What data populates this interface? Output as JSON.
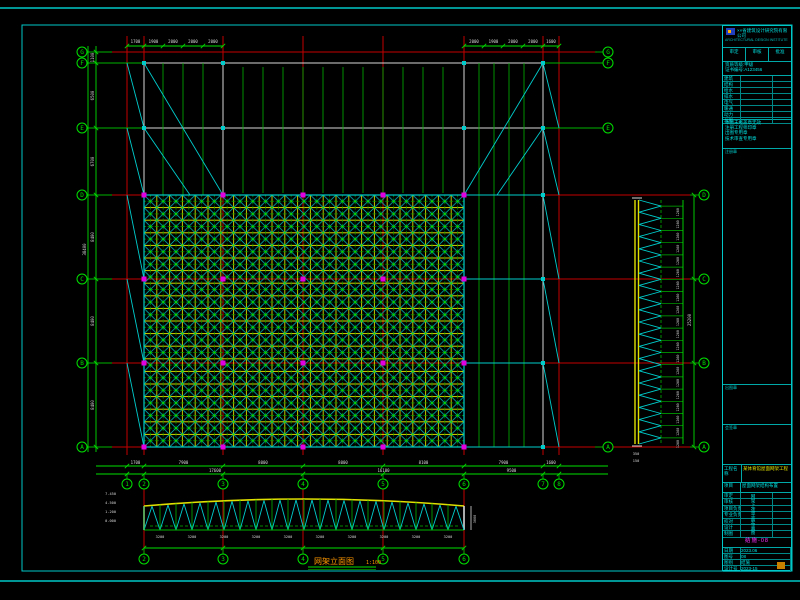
{
  "colors": {
    "background": "#000000",
    "sheet_border": "#00c8c8",
    "grid_red": "#c40000",
    "green": "#00b400",
    "bright_green": "#00e000",
    "yellow": "#e0e000",
    "cyan": "#00cccc",
    "white": "#d8d8d8",
    "magenta": "#e000e0",
    "orange": "#ff9900",
    "title_text": "#00e0e0"
  },
  "plan": {
    "col_grids": [
      {
        "label": "1",
        "x": 127
      },
      {
        "label": "2",
        "x": 144
      },
      {
        "label": "3",
        "x": 223
      },
      {
        "label": "4",
        "x": 303
      },
      {
        "label": "5",
        "x": 383
      },
      {
        "label": "6",
        "x": 464
      },
      {
        "label": "7",
        "x": 543
      },
      {
        "label": "8",
        "x": 559
      }
    ],
    "row_grids": [
      {
        "label": "G",
        "y": 52
      },
      {
        "label": "F",
        "y": 63
      },
      {
        "label": "E",
        "y": 128
      },
      {
        "label": "D",
        "y": 195
      },
      {
        "label": "C",
        "y": 279
      },
      {
        "label": "B",
        "y": 363
      },
      {
        "label": "A",
        "y": 447
      }
    ],
    "right_row_bubbles": [
      "G",
      "F",
      "E",
      "A"
    ],
    "top_dims_left": {
      "ticks": [
        127,
        144,
        163,
        183,
        203,
        223
      ],
      "values": [
        "1700",
        "1900",
        "2000",
        "2000",
        "2000"
      ]
    },
    "top_dims_right": {
      "ticks": [
        464,
        484,
        503,
        523,
        543,
        559
      ],
      "values": [
        "2000",
        "1900",
        "2000",
        "2000",
        "1600"
      ]
    },
    "left_dims": {
      "values": [
        "1100",
        "6500",
        "6700",
        "8400",
        "8400",
        "8400"
      ],
      "total": "38400"
    },
    "bottom_dims_row1": [
      "1700",
      "7900",
      "8000",
      "8000",
      "8100",
      "7900",
      "1600"
    ],
    "bottom_dims_row2": [
      {
        "x1": 127,
        "x2": 303,
        "t": "17600"
      },
      {
        "x1": 303,
        "x2": 464,
        "t": "16100"
      },
      {
        "x1": 464,
        "x2": 559,
        "t": "9500"
      }
    ]
  },
  "side_elevation": {
    "row_bubbles": [
      "D",
      "C",
      "B",
      "A"
    ],
    "panels": 20,
    "panel_dim": "1260",
    "total_dim": "25200",
    "bottom_texts": [
      "350",
      "150"
    ]
  },
  "truss_elevation": {
    "panels": 20,
    "panel_dim": "3200",
    "height_dim": "3000",
    "left_levels": [
      "7.450",
      "4.500",
      "1.200",
      "0.000"
    ],
    "bottom_bubbles": [
      "2",
      "3",
      "4",
      "5",
      "6"
    ],
    "title": "网架立面图",
    "scale": "1:100"
  },
  "title_block": {
    "org_name": "××省建筑设计研究院有限公司",
    "org_sub": "ARCHITECTURAL DESIGN INSTITUTE",
    "approve_row": [
      "审定",
      "审核",
      "批准"
    ],
    "cert_lines": [
      "资质等级:甲级",
      "证书编号:A123456"
    ],
    "sign_table_rows": [
      "建筑",
      "结构",
      "给水",
      "排水",
      "电气",
      "暖通",
      "动力",
      "总图"
    ],
    "notes": [
      "本图未经盖章无效",
      "注册工程师印章",
      "出图专用章",
      "技术审查专用章"
    ],
    "box_labels": [
      "注册章",
      "出图章",
      "会签章"
    ],
    "project_label": "工程名称",
    "project_name": "某体育馆屋面网架工程",
    "item_label": "项目",
    "item_value": "屋面网架结构布置",
    "mini_rows": [
      "审定",
      "审核",
      "项目负责",
      "专业负责",
      "校对",
      "设计",
      "制图"
    ],
    "drawing_name_vertical": "网架上弦平面布置图",
    "drawing_no": "结施-08",
    "bottom_rows": [
      [
        "设计号",
        "2023-15"
      ],
      [
        "图别",
        "结施"
      ],
      [
        "图号",
        "08"
      ],
      [
        "日期",
        "2023.06"
      ]
    ]
  }
}
